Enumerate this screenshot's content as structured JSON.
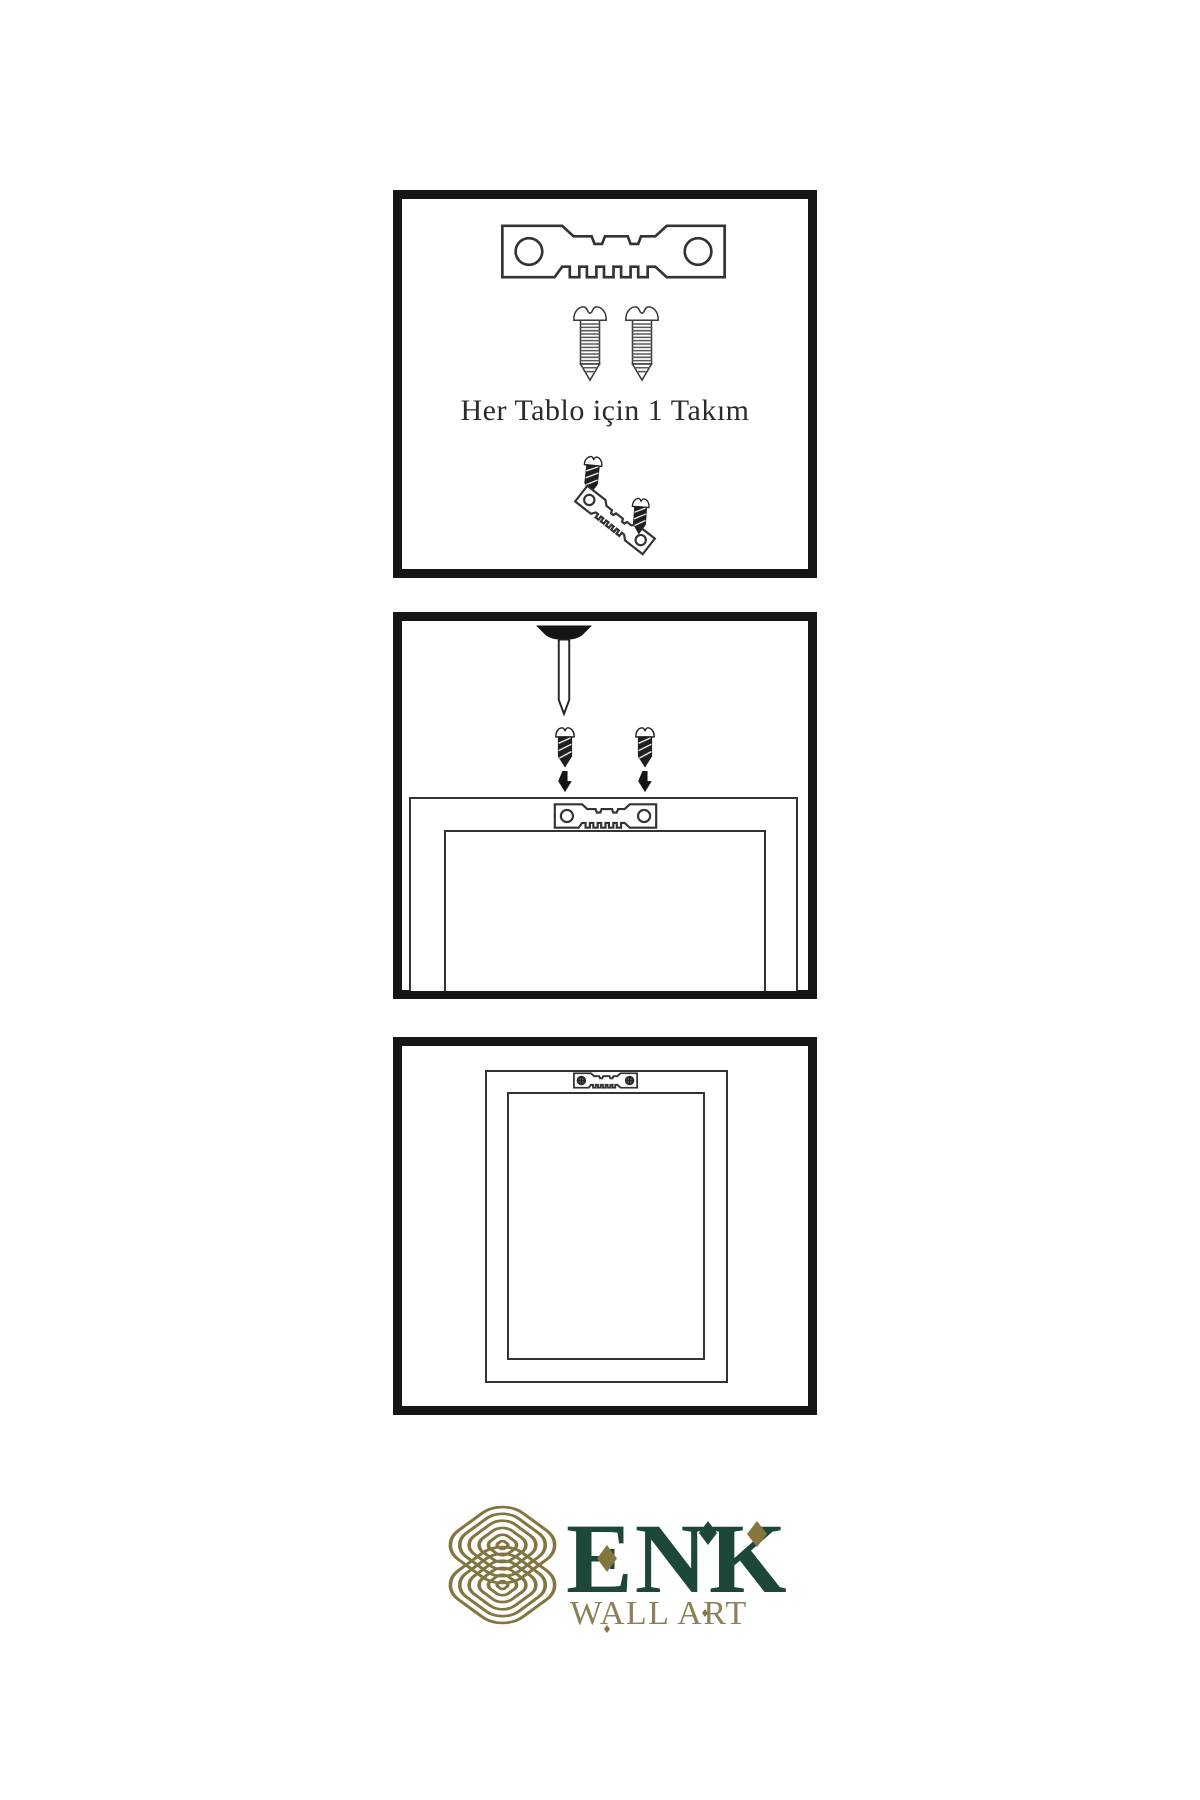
{
  "page": {
    "background": "#ffffff"
  },
  "steps": {
    "kit_caption": "Her Tablo için 1 Takım"
  },
  "logo": {
    "brand": "ENK",
    "tagline": "WALL ART"
  },
  "colors": {
    "background": "#ffffff",
    "panel-border": "#161616",
    "line": "#333333",
    "screw-dark": "#1f1f1f",
    "brand-green": "#1d4837",
    "brand-gold": "#85753f",
    "brand-tan": "#8d7f58"
  },
  "icons": {
    "sawtooth-hanger-icon": "flat metal strip, 2 round holes, sawtooth bottom edge",
    "mounted-sawtooth-hanger-icon": "sawtooth hanger fixed with 2 phillips screws",
    "screw-icon": "outlined screw with threaded shaft",
    "dark-screw-icon": "small black screw",
    "nail-icon": "nail driven down from wall edge",
    "arrow-down-icon": "solid black down arrow",
    "knot-logo-icon": "gold interlaced celtic knot, rounded diamond",
    "diamond-icon": "small rhombus accent"
  }
}
